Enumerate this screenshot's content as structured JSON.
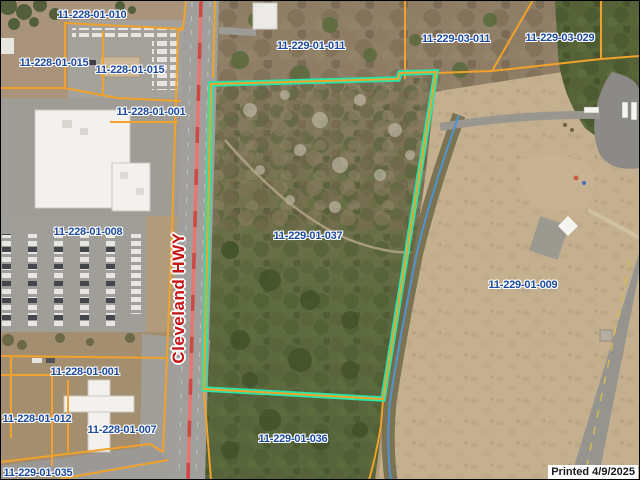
{
  "map": {
    "highlighted_parcel_id": "11-229-01-037",
    "road_label": "Cleveland HWY",
    "print_stamp": "Printed 4/9/2025",
    "parcel_labels": [
      {
        "id": "11-228-01-010"
      },
      {
        "id": "11-228-01-015"
      },
      {
        "id": "11-228-01-015"
      },
      {
        "id": "11-228-01-001"
      },
      {
        "id": "11-228-01-008"
      },
      {
        "id": "11-228-01-001"
      },
      {
        "id": "11-228-01-012"
      },
      {
        "id": "11-228-01-007"
      },
      {
        "id": "11-229-01-035"
      },
      {
        "id": "11-229-01-011"
      },
      {
        "id": "11-229-03-011"
      },
      {
        "id": "11-229-03-029"
      },
      {
        "id": "11-229-01-037"
      },
      {
        "id": "11-229-01-009"
      },
      {
        "id": "11-229-01-036"
      }
    ],
    "colors": {
      "parcel_line": "#f0a22a",
      "highlight_outline": "#2be4a9",
      "parcel_label_text": "#1c4a9e",
      "road_label_text": "#c31616",
      "stream_line": "#4e94d4"
    }
  }
}
